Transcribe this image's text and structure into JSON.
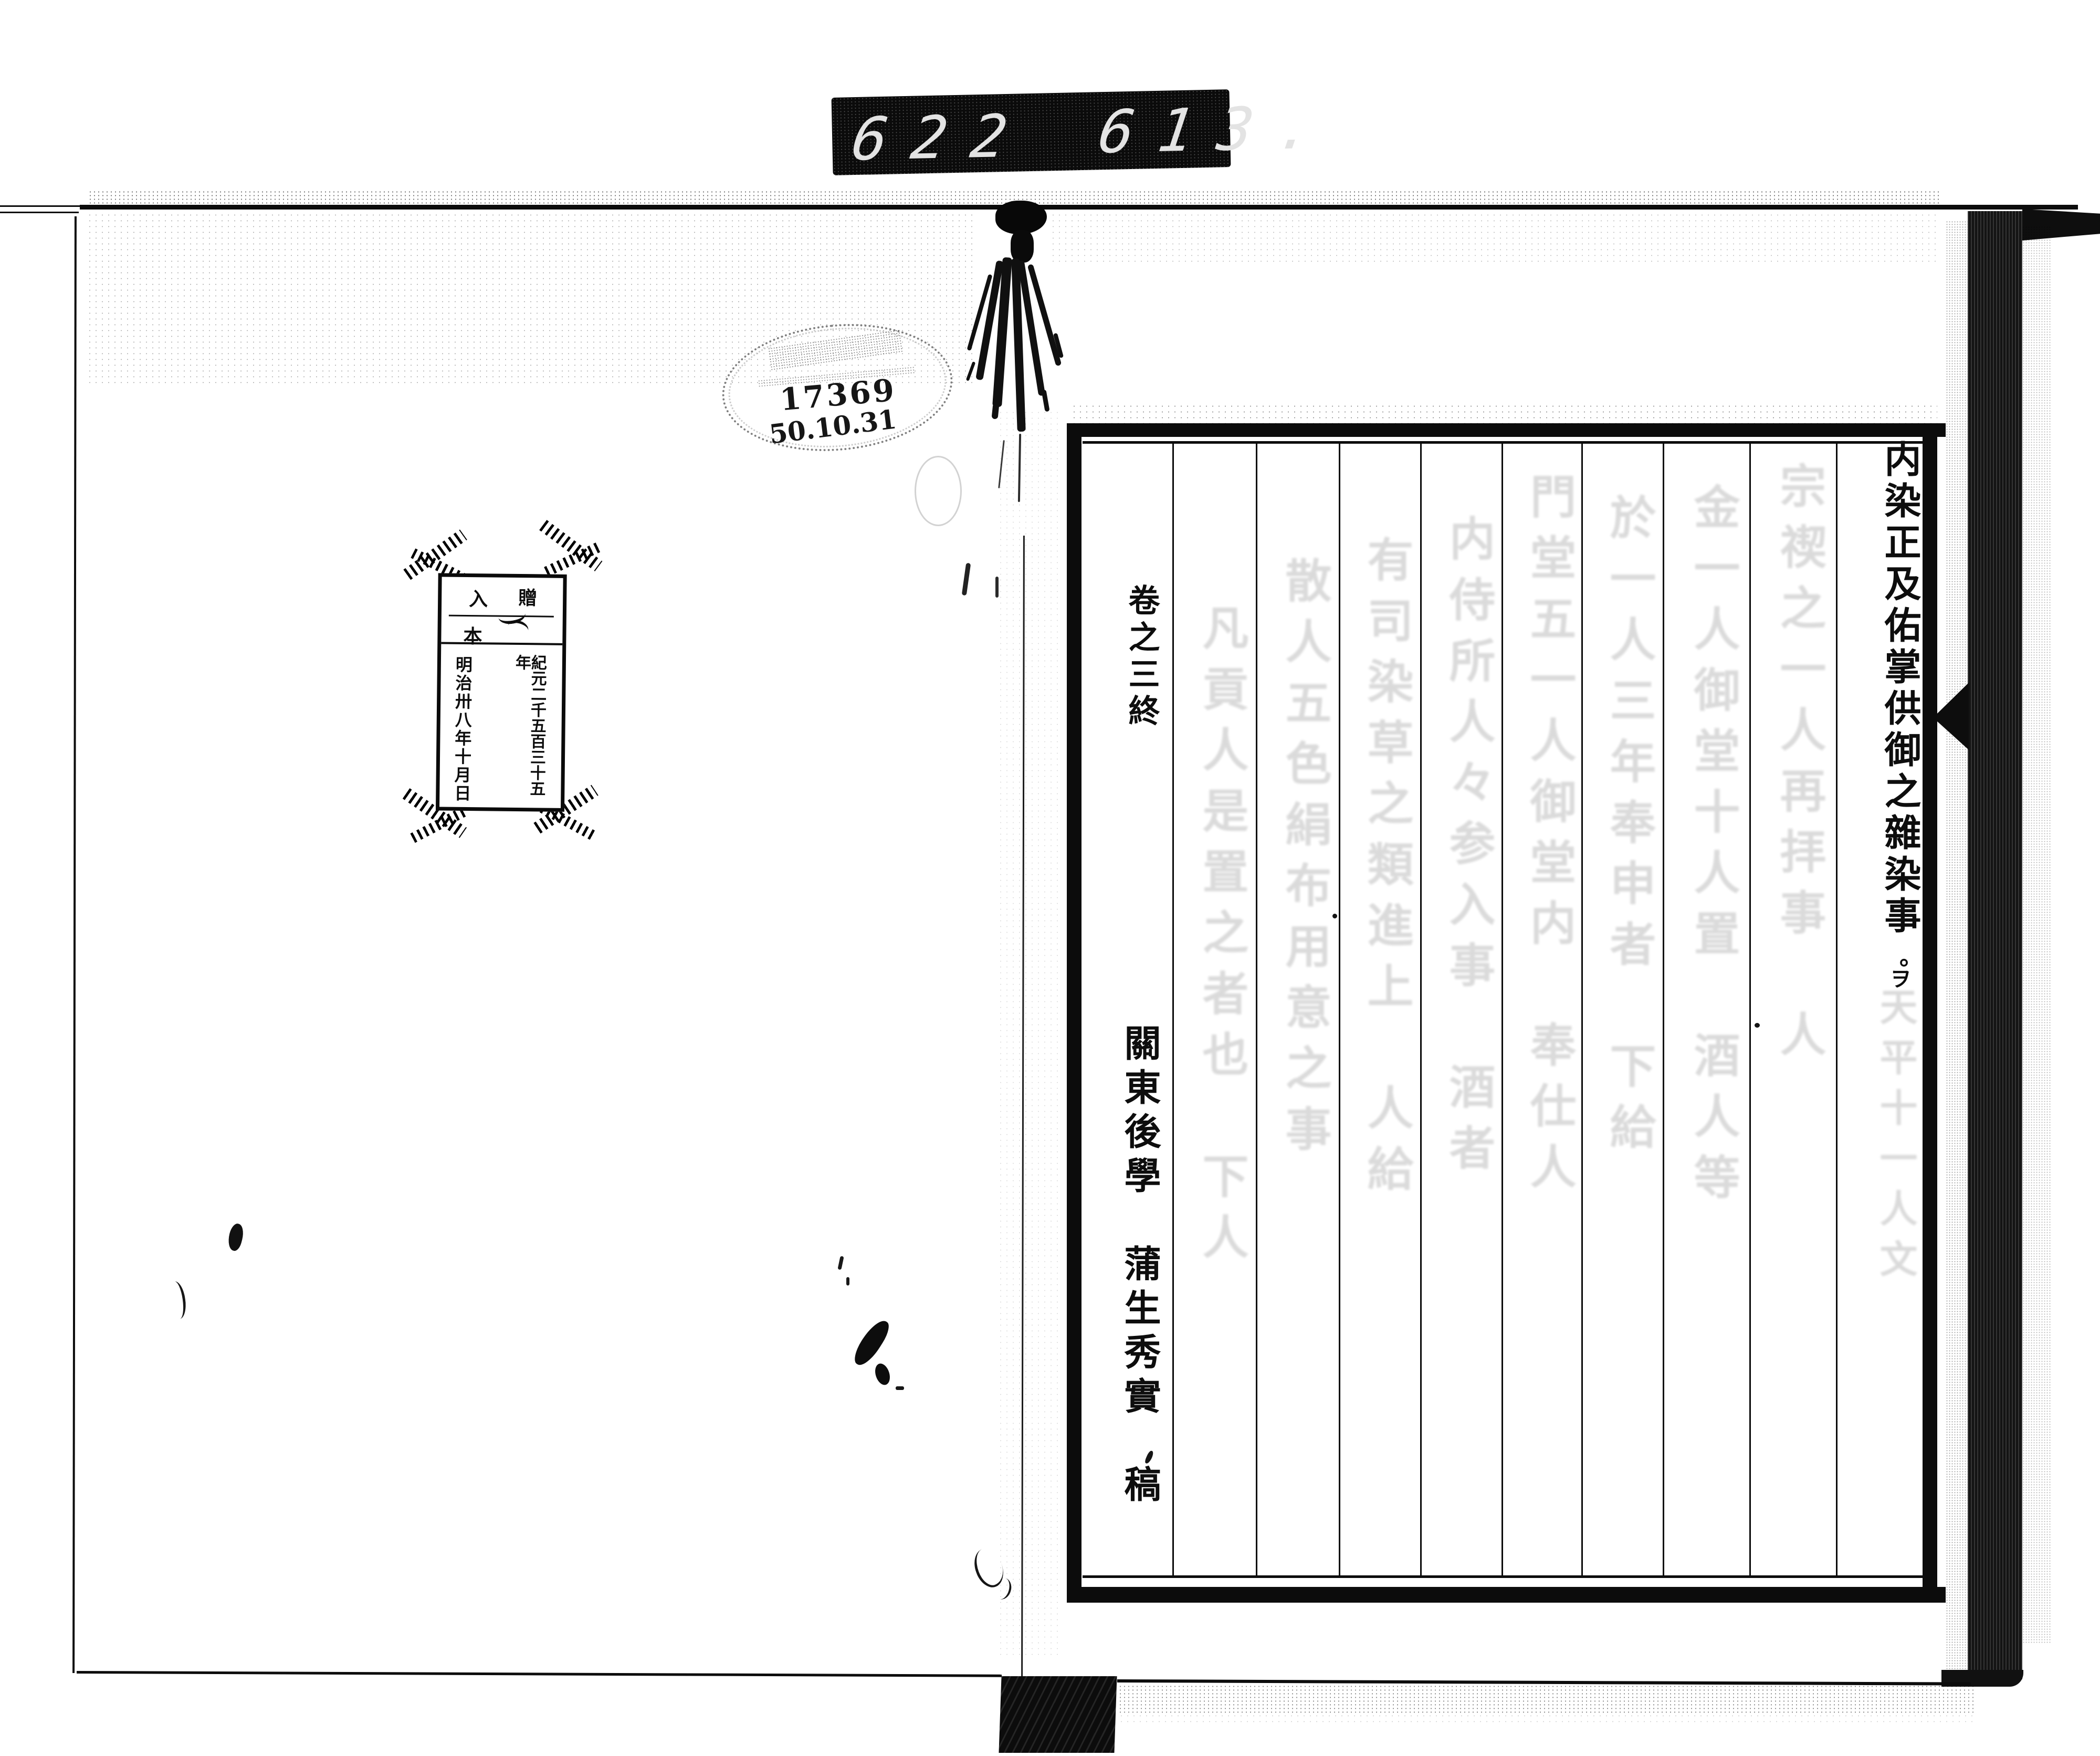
{
  "counter": {
    "group1": "622",
    "group2": "613."
  },
  "stamp": {
    "number": "17369",
    "date": "50.10.31"
  },
  "bookplate": {
    "donate_label": "贈",
    "enter_label": "入",
    "volume_label": "本",
    "era_column": "紀元二千五百三十五年",
    "meiji_column": "明治卅八年十月日"
  },
  "right_page": {
    "title": "内染正及佑掌供御之雜染事",
    "title_period": "。",
    "title_annotation": "ヲ",
    "volume_end": "卷之三終",
    "author": "關東後學　蒲生秀實　稿",
    "ghost_columns": [
      "凡貢人是置之者也　下人",
      "散人五色絹布用意之事",
      "有司染草之類進上　人給",
      "内侍所人々参入事　酒者",
      "門堂五一人御堂内　奉仕人",
      "於一人三年奉申者　下給",
      "金一人御堂十人置　酒人等",
      "宗禊之一人再拝事　人",
      "天平十一人文"
    ]
  }
}
